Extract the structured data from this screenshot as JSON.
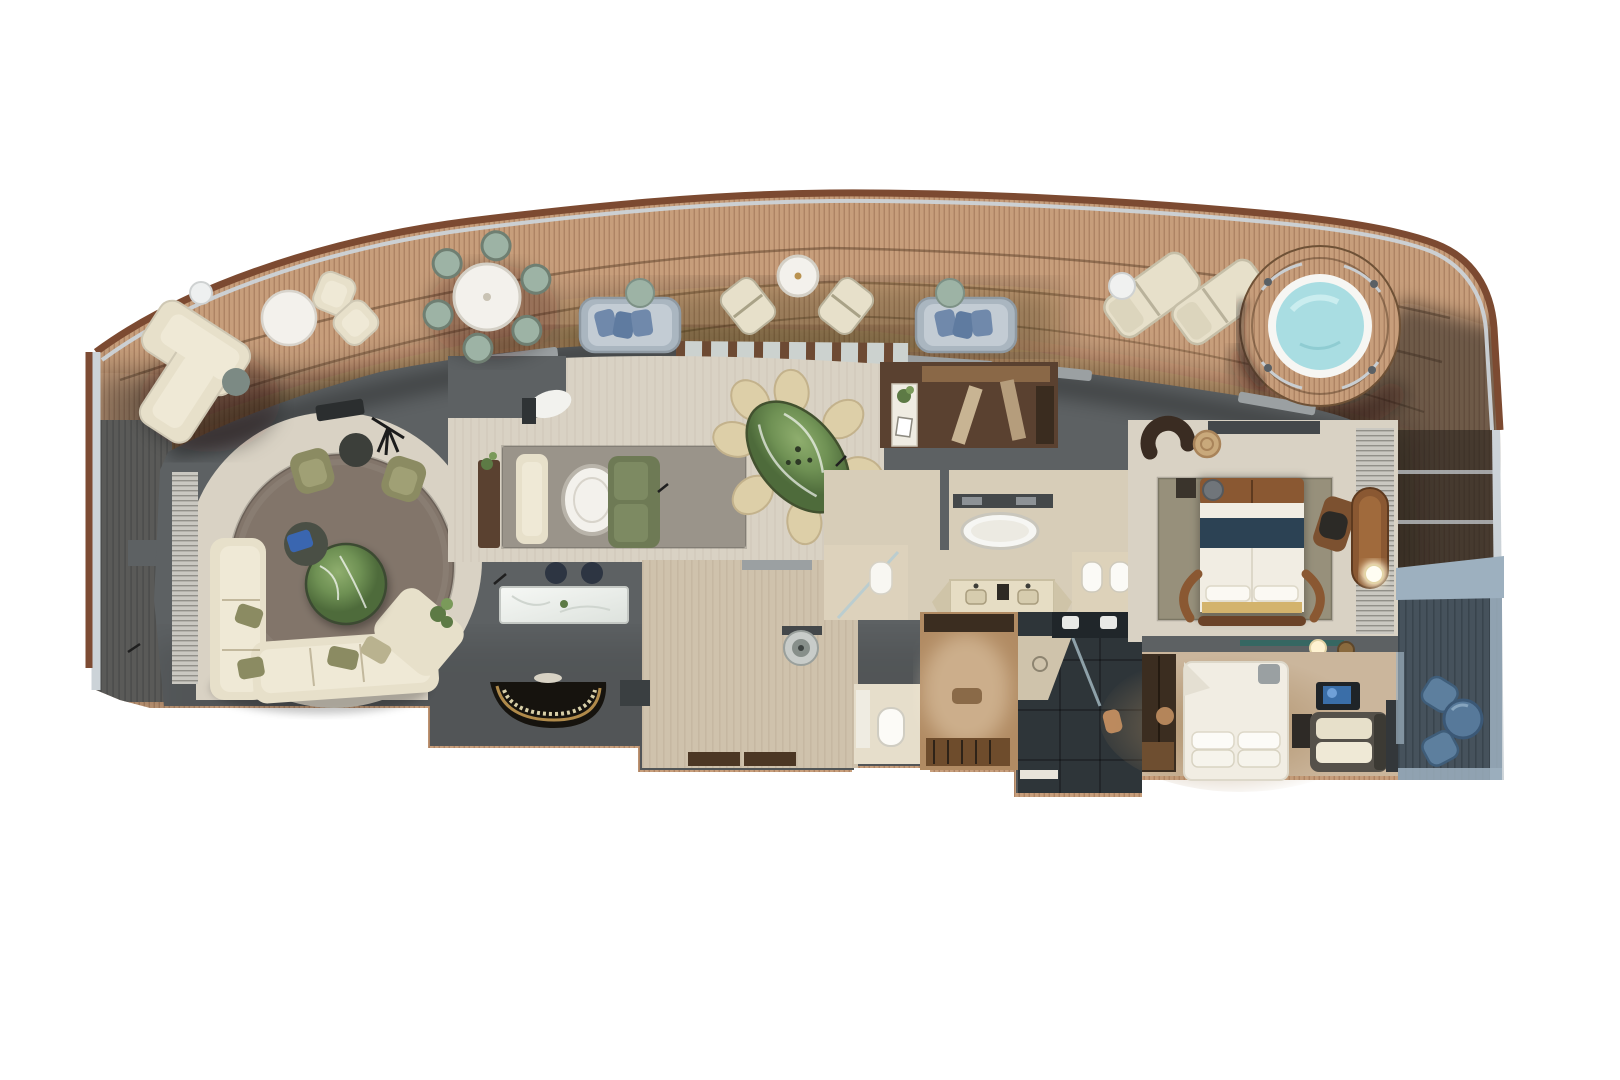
{
  "scene": {
    "kind": "cruise-ship-suite-floor-plan",
    "view": "top-down-3d-render",
    "regions": [
      {
        "name": "forward-balcony",
        "furniture": [
          "l-shaped-sofa",
          "round-coffee-table",
          "small-side-table",
          "two-armchairs",
          "sage-side-table",
          "round-dining-table-six-chairs",
          "two-daybeds",
          "two-sling-chairs",
          "round-table",
          "two-sun-loungers",
          "two-drink-tables",
          "rope-coil",
          "whirlpool-tub"
        ]
      },
      {
        "name": "living-lounge",
        "furniture": [
          "circular-rug",
          "sectional-sofa",
          "green-marble-coffee-table",
          "two-olive-armchairs",
          "round-side-table",
          "telescope",
          "louver-wardrobe",
          "plant"
        ]
      },
      {
        "name": "music-lounge",
        "furniture": [
          "area-rug",
          "wood-console",
          "chaise",
          "oval-table",
          "green-sofa",
          "sculpt-chair"
        ]
      },
      {
        "name": "wet-bar",
        "furniture": [
          "marble-counter",
          "two-bar-stools"
        ]
      },
      {
        "name": "grand-piano-nook",
        "furniture": [
          "grand-piano"
        ]
      },
      {
        "name": "dining-area",
        "furniture": [
          "green-marble-oval-table",
          "eight-chairs",
          "media-wall-with-plants"
        ]
      },
      {
        "name": "entry-foyer",
        "furniture": [
          "sculpture-basin",
          "entry-door-mats",
          "closet"
        ]
      },
      {
        "name": "pantry",
        "furniture": [
          "cabinetry",
          "console-with-plant"
        ]
      },
      {
        "name": "master-bathroom",
        "furniture": [
          "freestanding-tub",
          "towel-ledge",
          "double-vanity",
          "shower",
          "toilet",
          "bidet"
        ]
      },
      {
        "name": "walk-in-closet",
        "furniture": [
          "wardrobe-rails",
          "bench",
          "drawers"
        ]
      },
      {
        "name": "guest-bathroom",
        "furniture": [
          "double-sink-vanity",
          "shower",
          "stool"
        ]
      },
      {
        "name": "master-bedroom",
        "furniture": [
          "king-bed",
          "leather-headboard",
          "navy-runner",
          "foot-bench",
          "rug",
          "curved-armchair",
          "rattan-table",
          "desk",
          "desk-chair",
          "chaise",
          "floor-lamp",
          "louver-blinds"
        ]
      },
      {
        "name": "second-bedroom",
        "furniture": [
          "bed",
          "pillows",
          "tv",
          "sofa",
          "wardrobe",
          "dresser",
          "side-table"
        ]
      },
      {
        "name": "aft-private-balcony",
        "furniture": [
          "two-blue-chairs",
          "round-blue-table"
        ]
      }
    ]
  },
  "palette": {
    "white": "#ffffff",
    "deck": "#c79e7b",
    "deck_line": "#ac8262",
    "deck_dark": "#5a5a58",
    "deck_dark_line": "#4a4b4a",
    "railing": "#7c4a31",
    "railing_hi": "#a97a58",
    "hull_glass": "#ccd3d8",
    "hull_brown": "#7d4b33",
    "wall": "#5d6163",
    "wall_dark": "#44484a",
    "wall_light": "#9ba0a2",
    "floor": "#d9d2c4",
    "floor_wood": "#cfc2ac",
    "travertine": "#d7cdb8",
    "rug_living": "#82756a",
    "rug_gray": "#9a948a",
    "rug_bedroom": "#97907b",
    "sofa_cream": "#e7e0ca",
    "sofa_seat": "#efe9d6",
    "sofa_line": "#c6bca1",
    "chair_olive": "#8b8b62",
    "chair_olive_seat": "#a0a075",
    "sofa_green": "#6e7a55",
    "chair_dining": "#ddcfa8",
    "chair_dining_line": "#c3b28c",
    "table_white": "#f3f1ec",
    "table_rim": "#c9c4ba",
    "marble_hi": "#8fae6e",
    "marble_mid": "#6f9154",
    "marble_dark": "#4e6b3b",
    "marble_white": "#eff1ee",
    "wood_console": "#5a4130",
    "wood_mid": "#8a6847",
    "piano": "#16130e",
    "piano_gold": "#b08a4a",
    "stool_navy": "#2d3542",
    "bed_white": "#f1ede3",
    "bed_navy": "#2c4254",
    "leather": "#8a5832",
    "leather_dark": "#5e3a1f",
    "pillow_gray": "#70757a",
    "gold_throw": "#d3b36c",
    "lamp_glow": "#fff3d2",
    "tub_white": "#f6f6f3",
    "water": "#a9dde2",
    "water_hi": "#c9ecef",
    "sage": "#9db3a5",
    "sage_dark": "#6f7f72",
    "cushion_blue": "#7089ab",
    "daybed_frame": "#aab6c0",
    "daybed_mat": "#c3ccd4",
    "tan_closet": "#b18b63",
    "closet_dark": "#3b2d20",
    "bath_dark": "#2e3539",
    "bath_dark2": "#20262a",
    "balcony_slat": "#46525c",
    "balcony_slat_line": "#39444d",
    "balcony_frame": "#9db0bf",
    "chair_blue": "#5d7f9e",
    "chair_blue_dark": "#3f5d79",
    "tv_screen": "#3a6ea8",
    "plant": "#5d7a45",
    "plant_hi": "#7a9a5a",
    "glass_door": "#ccd2cf",
    "mullion": "#6d4a33",
    "louver": "#cac8c1",
    "louver_line": "#918f88",
    "warm_floor": "#cbb69c",
    "warm_shadow": "#a9885f"
  }
}
